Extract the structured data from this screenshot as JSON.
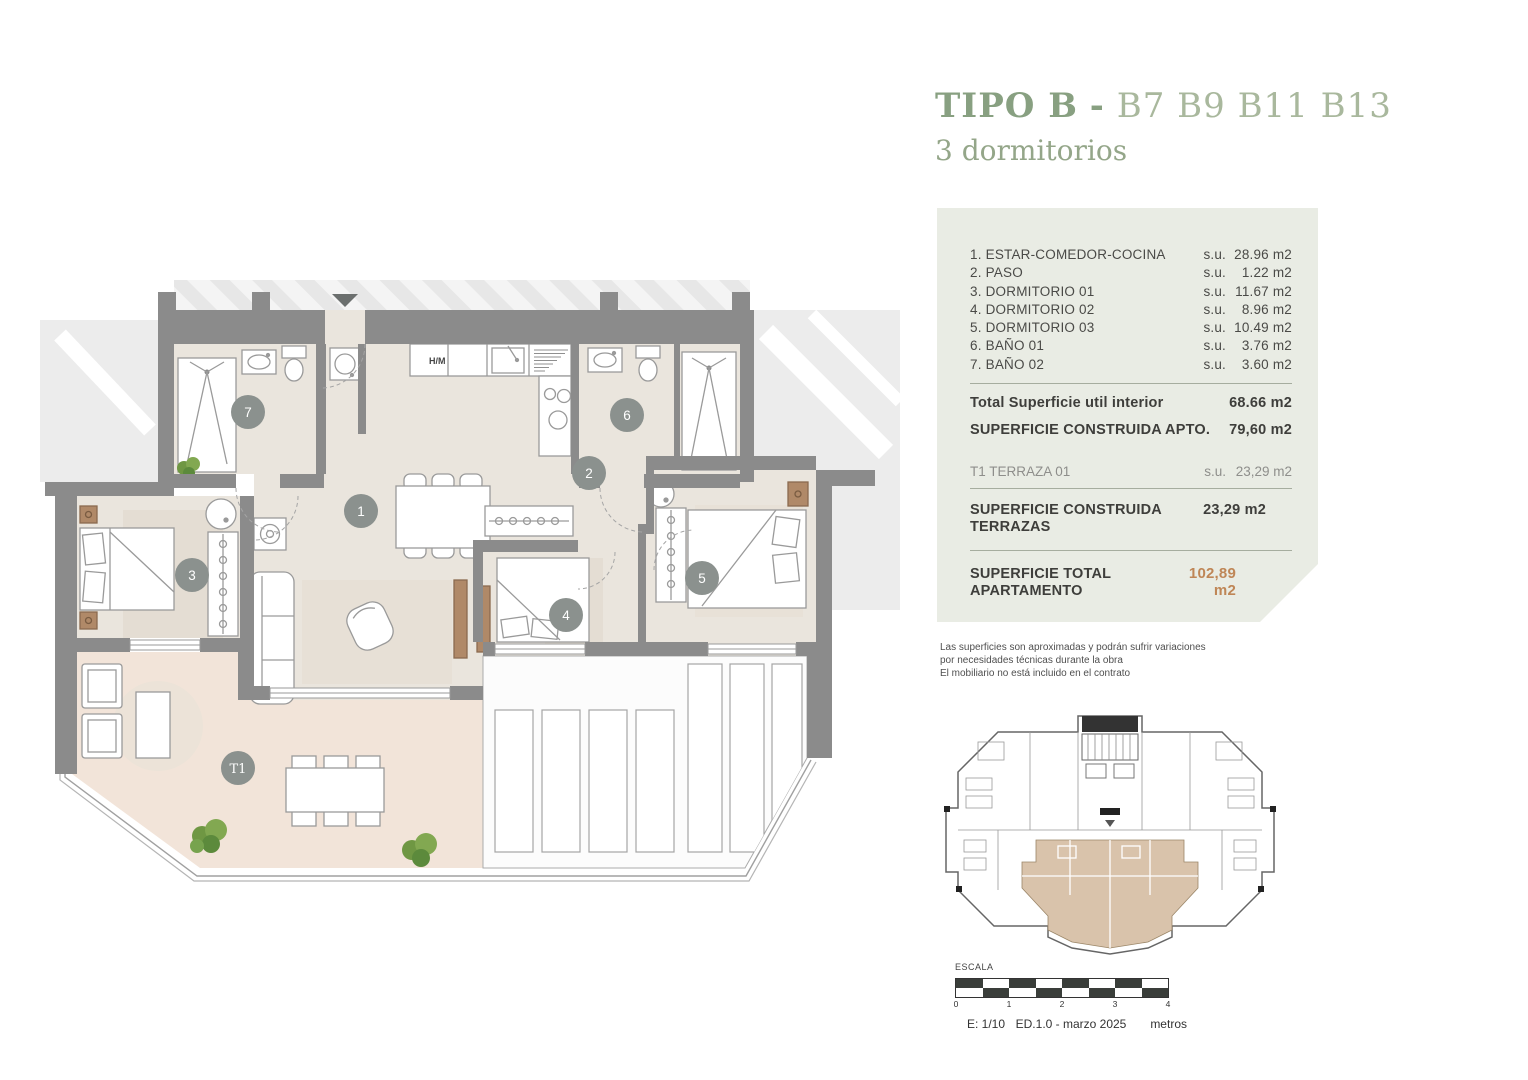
{
  "title": {
    "type_label": "TIPO B",
    "separator": "-",
    "units": "B7 B9 B11 B13",
    "subtitle": "3 dormitorios"
  },
  "panel": {
    "su_label": "s.u.",
    "rooms": [
      {
        "label": "1. ESTAR-COMEDOR-COCINA",
        "value": "28.96 m2"
      },
      {
        "label": "2. PASO",
        "value": "1.22 m2"
      },
      {
        "label": "3. DORMITORIO 01",
        "value": "11.67 m2"
      },
      {
        "label": "4. DORMITORIO 02",
        "value": "8.96 m2"
      },
      {
        "label": "5. DORMITORIO 03",
        "value": "10.49 m2"
      },
      {
        "label": "6. BAÑO 01",
        "value": "3.76 m2"
      },
      {
        "label": "7. BAÑO 02",
        "value": "3.60 m2"
      }
    ],
    "totals": {
      "util": {
        "label": "Total Superficie util interior",
        "value": "68.66 m2"
      },
      "construida_apto": {
        "label": "SUPERFICIE CONSTRUIDA APTO.",
        "value": "79,60 m2"
      },
      "terraza": {
        "label": "T1 TERRAZA 01",
        "su": "s.u.",
        "value": "23,29 m2"
      },
      "construida_terrazas": {
        "label": "SUPERFICIE CONSTRUIDA TERRAZAS",
        "value": "23,29 m2"
      },
      "total": {
        "label": "SUPERFICIE TOTAL APARTAMENTO",
        "value": "102,89 m2"
      }
    }
  },
  "disclaimer": {
    "line1": "Las superficies son aproximadas y podrán sufrir variaciones",
    "line2": "por necesidades técnicas durante la obra",
    "line3": "El mobiliario no está incluido en el contrato"
  },
  "plan": {
    "kitchen_label": "H/M",
    "markers": {
      "m1": "1",
      "m2": "2",
      "m3": "3",
      "m4": "4",
      "m5": "5",
      "m6": "6",
      "m7": "7",
      "t1": "T1"
    }
  },
  "scale": {
    "label": "ESCALA",
    "ticks": [
      "0",
      "1",
      "2",
      "3",
      "4"
    ],
    "ratio": "E: 1/10",
    "edition": "ED.1.0 - marzo 2025",
    "unit": "metros"
  },
  "colors": {
    "accent_green": "#88a081",
    "accent_green_light": "#a9b89d",
    "accent_tan": "#bf8656",
    "panel_bg": "#e9ece4",
    "wall_gray": "#8b8b8b",
    "floor_beige": "#eae5dd",
    "terrace_pink": "#f2e4d9",
    "marker_gray": "#8b918e"
  }
}
